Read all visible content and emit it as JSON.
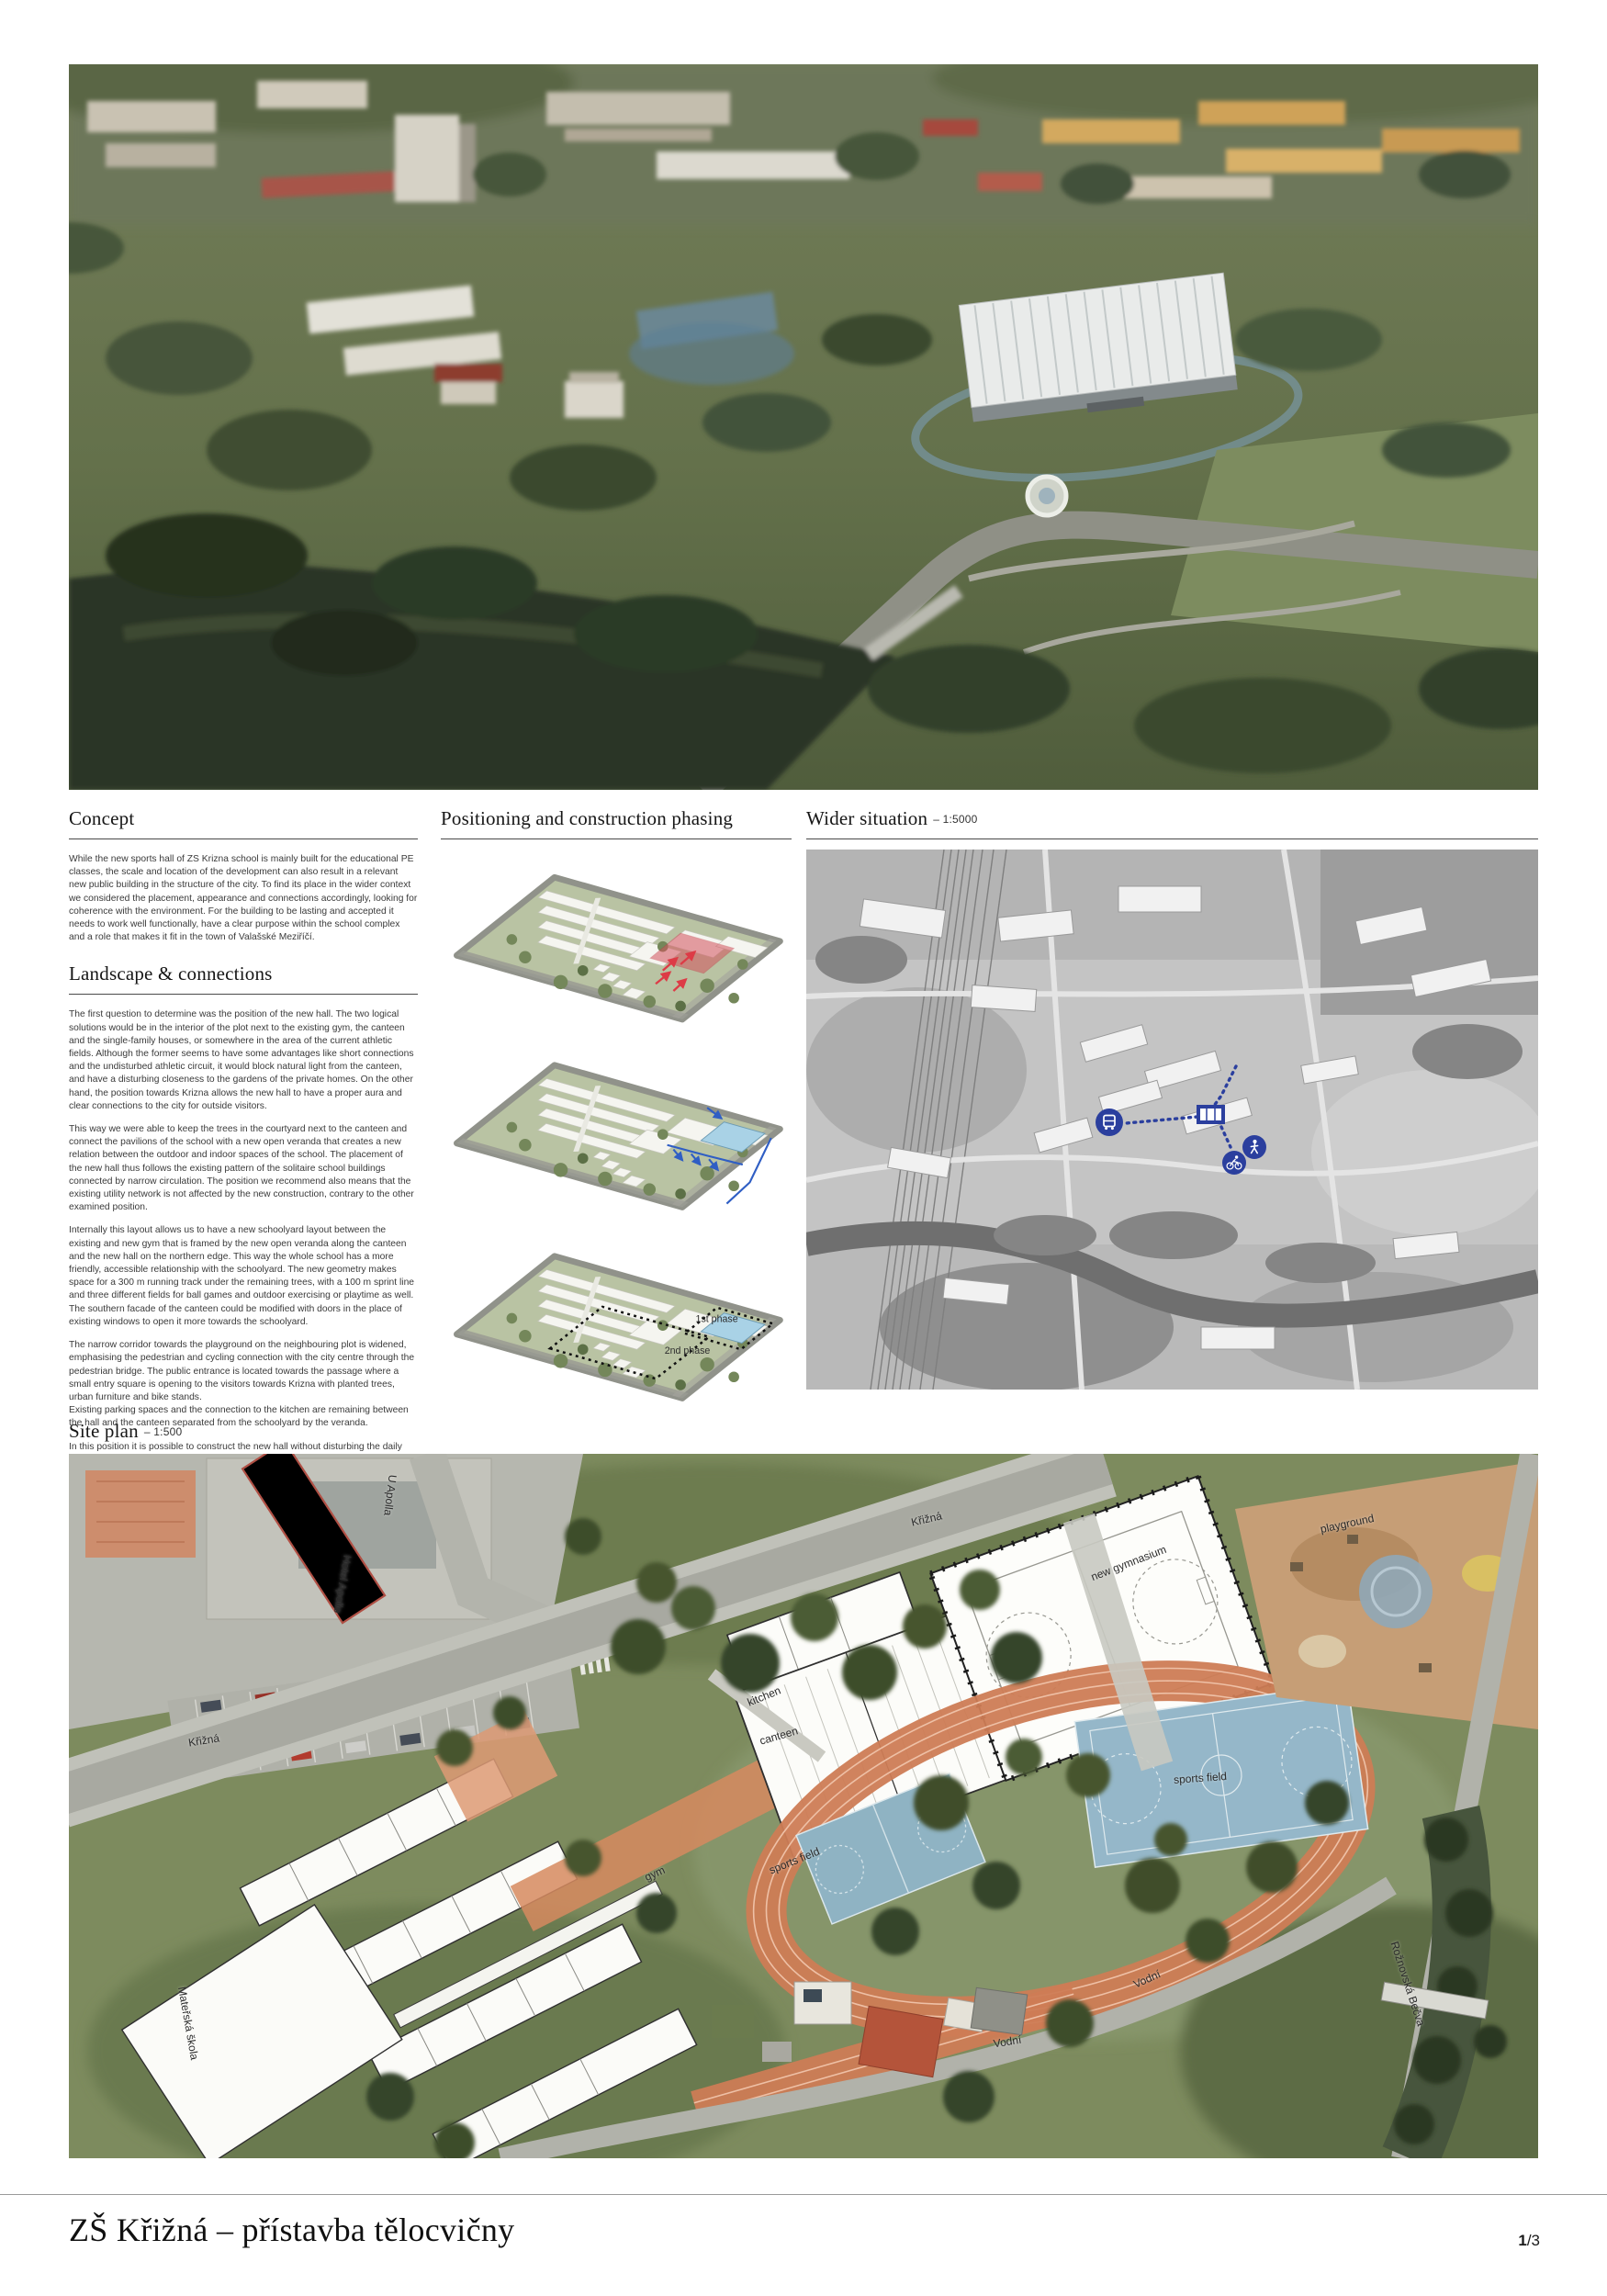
{
  "concept": {
    "heading": "Concept",
    "body": "While the new sports hall of ZS Krizna school is mainly built for the educational PE classes, the scale and location of the development can also result in a relevant new public building in the structure of the city. To find its place in the wider context we considered the placement, appearance and connections accordingly, looking for coherence with the environment. For the building to be lasting and accepted it needs to work well functionally, have a clear purpose within the school complex and a role that makes it fit in the town of Valašské Meziříčí."
  },
  "landscape": {
    "heading": "Landscape & connections",
    "paragraphs": [
      "The first question to determine was the position of the new hall. The two logical solutions would be in the interior of the plot next to the existing gym, the canteen and the single-family houses, or somewhere in the area of the current athletic fields. Although the former seems to have some advantages like short connections and the undisturbed athletic circuit, it would block natural light from the canteen, and have a disturbing closeness to the gardens of the private homes. On the other hand, the position towards Krizna allows the new hall to have a proper aura and clear connections to the city for outside visitors.",
      "This way we were able to keep the trees in the courtyard next to the canteen and connect the pavilions of the school with a new open veranda that creates a new relation between the outdoor and indoor spaces of the school. The placement of the new hall thus follows the existing pattern of the solitaire school buildings connected by narrow circulation. The position we recommend also means that the existing utility network is not affected by the new construction, contrary to the other examined position.",
      "Internally this layout allows us to have a new schoolyard layout between the existing and new gym that is framed by the new open veranda along the canteen and the new hall on the northern edge. This way the whole school has a more friendly, accessible relationship with the schoolyard. The new geometry makes space for a 300 m running track under the remaining trees, with a 100 m sprint line and three different fields for ball games and outdoor exercising or playtime as well. The southern facade of the canteen could be modified with doors in the place of existing windows to open it more towards the schoolyard.",
      "The narrow corridor towards the playground on the neighbouring plot is widened, emphasising the pedestrian and cycling connection with the city centre through the pedestrian bridge. The public entrance is located towards the passage where a small entry square is opening to the visitors towards Krizna with planted trees, urban furniture and bike stands.",
      "Existing parking spaces and the connection to the kitchen are remaining between the hall and the canteen separated from the schoolyard by the veranda.",
      "In this position it is possible to construct the new hall without disturbing the daily use of the existing buildings, and implement the schoolyard reconstruction in a second phase when the new building is accessible for physical education."
    ]
  },
  "phasing": {
    "heading": "Positioning and construction phasing",
    "phase1_label": "1st phase",
    "phase2_label": "2nd phase"
  },
  "wider": {
    "heading": "Wider situation",
    "scale": "– 1:5000",
    "map_icons": [
      "bus-icon",
      "pedestrian-icon",
      "cyclist-icon"
    ]
  },
  "siteplan": {
    "heading": "Site plan",
    "scale": "– 1:500",
    "labels": [
      {
        "text": "U Apolla"
      },
      {
        "text": "Hotel Apollo"
      },
      {
        "text": "Křižná"
      },
      {
        "text": "Křižná"
      },
      {
        "text": "new gymnasium"
      },
      {
        "text": "playground"
      },
      {
        "text": "kitchen"
      },
      {
        "text": "canteen"
      },
      {
        "text": "gym"
      },
      {
        "text": "sports field"
      },
      {
        "text": "sports field"
      },
      {
        "text": "Mateřská škola"
      },
      {
        "text": "Vodní"
      },
      {
        "text": "Vodní"
      },
      {
        "text": "Rožnovská Bečva"
      }
    ]
  },
  "footer": {
    "title": "ZŠ Křižná – přístavba tělocvičny",
    "page_current": "1",
    "page_total": "/3"
  },
  "colors": {
    "annotation_blue": "#2b3f9e",
    "phase_red": "#d4535d",
    "hall_blue": "#a9d2e6",
    "track_orange": "#cd7c55",
    "court_blue": "#8fb3c3",
    "veranda_salmon": "#d6895f"
  }
}
